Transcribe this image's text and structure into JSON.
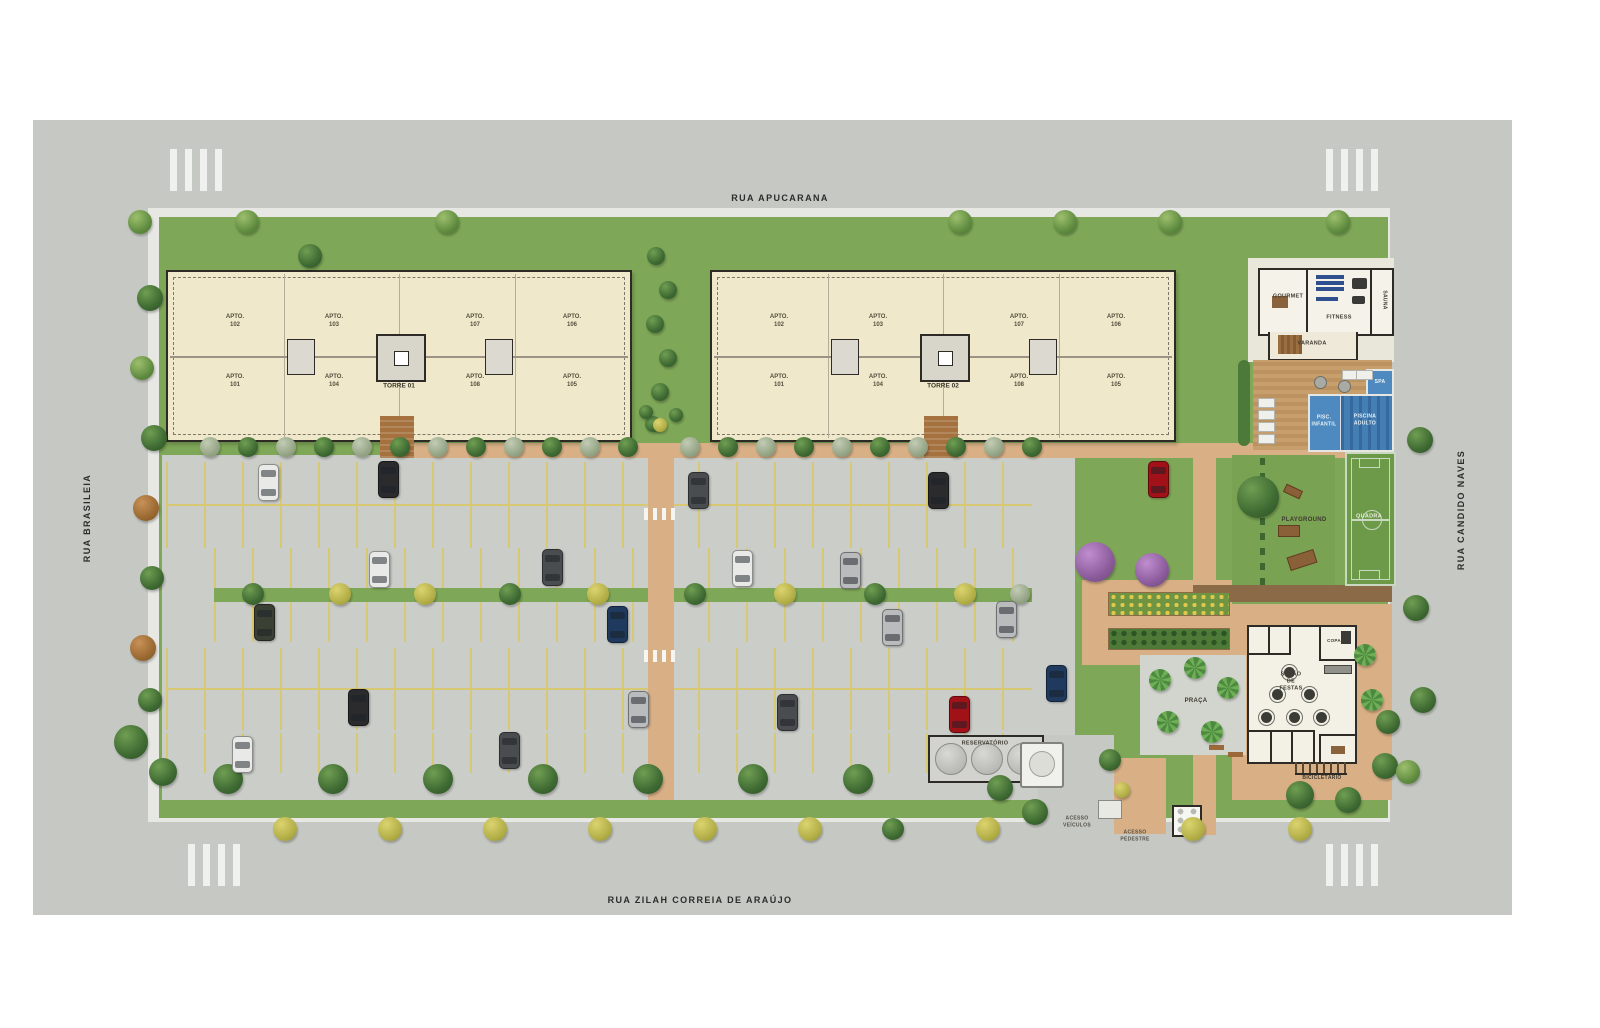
{
  "streets": {
    "top": "RUA APUCARANA",
    "bottom": "RUA ZILAH CORREIA DE ARAÚJO",
    "left": "RUA BRASILEIA",
    "right": "RUA CANDIDO NAVES"
  },
  "colors": {
    "stall": "#d8c873",
    "grass": "#7ea757",
    "asphalt": "#cbcdc9",
    "street": "#c6c8c3",
    "path": "#d9b086",
    "pool": "#3e7cb5",
    "cars": {
      "white": "#e9e9e7",
      "black": "#2b2b2d",
      "charcoal": "#4a4d4f",
      "silver": "#b9bbbd",
      "navy": "#1f3a5e",
      "red": "#a01218",
      "olive": "#3a4034"
    }
  },
  "towers": [
    {
      "label": "TORRE 01",
      "x": 166,
      "y": 270,
      "w": 462,
      "h": 168,
      "apts_top": [
        "APTO.\n102",
        "APTO.\n103",
        "APTO.\n107",
        "APTO.\n106"
      ],
      "apts_bottom": [
        "APTO.\n101",
        "APTO.\n104",
        "APTO.\n108",
        "APTO.\n105"
      ]
    },
    {
      "label": "TORRE 02",
      "x": 710,
      "y": 270,
      "w": 462,
      "h": 168,
      "apts_top": [
        "APTO.\n102",
        "APTO.\n103",
        "APTO.\n107",
        "APTO.\n106"
      ],
      "apts_bottom": [
        "APTO.\n101",
        "APTO.\n104",
        "APTO.\n108",
        "APTO.\n105"
      ]
    }
  ],
  "parking": {
    "bands": [
      [
        166,
        462,
        866,
        42,
        0
      ],
      [
        166,
        504,
        866,
        42,
        1
      ],
      [
        214,
        548,
        818,
        40,
        0
      ],
      [
        214,
        602,
        818,
        40,
        0
      ],
      [
        166,
        648,
        866,
        40,
        0
      ],
      [
        166,
        688,
        866,
        40,
        1
      ],
      [
        166,
        733,
        866,
        40,
        0
      ]
    ]
  },
  "labels": [
    {
      "name": "gourmet-label",
      "t": "GOURMET",
      "x": 1288,
      "y": 297,
      "fs": 5.5
    },
    {
      "name": "fitness-label",
      "t": "FITNESS",
      "x": 1339,
      "y": 318,
      "fs": 5.5
    },
    {
      "name": "sauna-label",
      "t": "SAUNA",
      "x": 1384,
      "y": 300,
      "fs": 5,
      "rot": 90
    },
    {
      "name": "varanda-label",
      "t": "VARANDA",
      "x": 1312,
      "y": 344,
      "fs": 5.5
    },
    {
      "name": "spa-label",
      "t": "SPA",
      "x": 1380,
      "y": 382,
      "fs": 5,
      "c": "#f2f6fa"
    },
    {
      "name": "piscina-infantil-label",
      "t": "PISC.\nINFANTIL",
      "x": 1324,
      "y": 421,
      "fs": 5,
      "c": "#eaf2f8"
    },
    {
      "name": "piscina-adulto-label",
      "t": "PISCINA\nADULTO",
      "x": 1365,
      "y": 420,
      "fs": 5,
      "c": "#eaf2f8"
    },
    {
      "name": "playground-label",
      "t": "PLAYGROUND",
      "x": 1304,
      "y": 521,
      "fs": 6
    },
    {
      "name": "quadra-label",
      "t": "QUADRA",
      "x": 1369,
      "y": 517,
      "fs": 5.5,
      "c": "#e8efe0"
    },
    {
      "name": "praca-label",
      "t": "PRAÇA",
      "x": 1196,
      "y": 702,
      "fs": 6
    },
    {
      "name": "salao-festas-label",
      "t": "SALÃO DE\nFESTAS",
      "x": 1291,
      "y": 682,
      "fs": 5.5
    },
    {
      "name": "copa-label",
      "t": "COPA",
      "x": 1334,
      "y": 641,
      "fs": 4.5
    },
    {
      "name": "bicicletario-label",
      "t": "BICICLETÁRIO",
      "x": 1322,
      "y": 778,
      "fs": 5
    },
    {
      "name": "reservatorio-label",
      "t": "RESERVATÓRIO",
      "x": 985,
      "y": 744,
      "fs": 5.5
    },
    {
      "name": "acesso-veiculos-label",
      "t": "ACESSO\nVEÍCULOS",
      "x": 1077,
      "y": 822,
      "fs": 5,
      "c": "#55524a"
    },
    {
      "name": "acesso-pedestre-label",
      "t": "ACESSO\nPEDESTRE",
      "x": 1135,
      "y": 836,
      "fs": 5,
      "c": "#55524a"
    }
  ],
  "trees": [
    [
      140,
      222,
      24,
      "m"
    ],
    [
      247,
      222,
      24,
      "m"
    ],
    [
      447,
      222,
      24,
      "m"
    ],
    [
      960,
      222,
      24,
      "m"
    ],
    [
      1065,
      222,
      24,
      "m"
    ],
    [
      1170,
      222,
      24,
      "m"
    ],
    [
      1338,
      222,
      24,
      "m"
    ],
    [
      310,
      256,
      24,
      "g"
    ],
    [
      656,
      256,
      18,
      "g"
    ],
    [
      668,
      290,
      18,
      "g"
    ],
    [
      655,
      324,
      18,
      "g"
    ],
    [
      668,
      358,
      18,
      "g"
    ],
    [
      660,
      392,
      18,
      "g"
    ],
    [
      653,
      424,
      16,
      "g"
    ],
    [
      210,
      447,
      20,
      "s"
    ],
    [
      248,
      447,
      20,
      "g"
    ],
    [
      286,
      447,
      20,
      "s"
    ],
    [
      324,
      447,
      20,
      "g"
    ],
    [
      362,
      447,
      20,
      "s"
    ],
    [
      400,
      447,
      20,
      "g"
    ],
    [
      438,
      447,
      20,
      "s"
    ],
    [
      476,
      447,
      20,
      "g"
    ],
    [
      514,
      447,
      20,
      "s"
    ],
    [
      552,
      447,
      20,
      "g"
    ],
    [
      590,
      447,
      20,
      "s"
    ],
    [
      628,
      447,
      20,
      "g"
    ],
    [
      690,
      447,
      20,
      "s"
    ],
    [
      728,
      447,
      20,
      "g"
    ],
    [
      766,
      447,
      20,
      "s"
    ],
    [
      804,
      447,
      20,
      "g"
    ],
    [
      842,
      447,
      20,
      "s"
    ],
    [
      880,
      447,
      20,
      "g"
    ],
    [
      918,
      447,
      20,
      "s"
    ],
    [
      956,
      447,
      20,
      "g"
    ],
    [
      994,
      447,
      20,
      "s"
    ],
    [
      1032,
      447,
      20,
      "g"
    ],
    [
      253,
      594,
      22,
      "g"
    ],
    [
      340,
      594,
      22,
      "y"
    ],
    [
      425,
      594,
      22,
      "y"
    ],
    [
      510,
      594,
      22,
      "g"
    ],
    [
      598,
      594,
      22,
      "y"
    ],
    [
      695,
      594,
      22,
      "g"
    ],
    [
      785,
      594,
      22,
      "y"
    ],
    [
      875,
      594,
      22,
      "g"
    ],
    [
      965,
      594,
      22,
      "y"
    ],
    [
      1020,
      594,
      20,
      "s"
    ],
    [
      228,
      779,
      30,
      "g"
    ],
    [
      333,
      779,
      30,
      "g"
    ],
    [
      438,
      779,
      30,
      "g"
    ],
    [
      543,
      779,
      30,
      "g"
    ],
    [
      648,
      779,
      30,
      "g"
    ],
    [
      753,
      779,
      30,
      "g"
    ],
    [
      858,
      779,
      30,
      "g"
    ],
    [
      1000,
      788,
      26,
      "g"
    ],
    [
      285,
      829,
      24,
      "y"
    ],
    [
      390,
      829,
      24,
      "y"
    ],
    [
      495,
      829,
      24,
      "y"
    ],
    [
      600,
      829,
      24,
      "y"
    ],
    [
      705,
      829,
      24,
      "y"
    ],
    [
      810,
      829,
      24,
      "y"
    ],
    [
      893,
      829,
      22,
      "g"
    ],
    [
      988,
      829,
      24,
      "y"
    ],
    [
      1193,
      829,
      24,
      "y"
    ],
    [
      1300,
      829,
      24,
      "y"
    ],
    [
      150,
      298,
      26,
      "g"
    ],
    [
      142,
      368,
      24,
      "m"
    ],
    [
      154,
      438,
      26,
      "g"
    ],
    [
      146,
      508,
      26,
      "o"
    ],
    [
      152,
      578,
      24,
      "g"
    ],
    [
      143,
      648,
      26,
      "o"
    ],
    [
      150,
      700,
      24,
      "g"
    ],
    [
      131,
      742,
      34,
      "g"
    ],
    [
      163,
      772,
      28,
      "g"
    ],
    [
      1095,
      562,
      40,
      "p"
    ],
    [
      1152,
      570,
      34,
      "p"
    ],
    [
      1258,
      497,
      42,
      "g"
    ],
    [
      1160,
      680,
      22,
      "l"
    ],
    [
      1195,
      668,
      22,
      "l"
    ],
    [
      1228,
      688,
      22,
      "l"
    ],
    [
      1168,
      722,
      22,
      "l"
    ],
    [
      1212,
      732,
      22,
      "l"
    ],
    [
      1365,
      655,
      22,
      "l"
    ],
    [
      1372,
      700,
      22,
      "l"
    ],
    [
      1300,
      795,
      28,
      "g"
    ],
    [
      1348,
      800,
      26,
      "g"
    ],
    [
      1385,
      766,
      26,
      "g"
    ],
    [
      1388,
      722,
      24,
      "g"
    ],
    [
      1420,
      440,
      26,
      "g"
    ],
    [
      1416,
      608,
      26,
      "g"
    ],
    [
      1423,
      700,
      26,
      "g"
    ],
    [
      1408,
      772,
      24,
      "m"
    ],
    [
      646,
      412,
      14,
      "g"
    ],
    [
      660,
      425,
      14,
      "y"
    ],
    [
      676,
      415,
      14,
      "g"
    ],
    [
      1035,
      812,
      26,
      "g"
    ],
    [
      1110,
      760,
      22,
      "g"
    ],
    [
      1122,
      790,
      16,
      "y"
    ]
  ],
  "cars": [
    [
      267,
      481,
      "white"
    ],
    [
      387,
      478,
      "black"
    ],
    [
      697,
      489,
      "charcoal"
    ],
    [
      937,
      489,
      "black"
    ],
    [
      1157,
      478,
      "red"
    ],
    [
      378,
      568,
      "white"
    ],
    [
      551,
      566,
      "charcoal"
    ],
    [
      741,
      567,
      "white"
    ],
    [
      849,
      569,
      "silver"
    ],
    [
      263,
      621,
      "olive"
    ],
    [
      616,
      623,
      "navy"
    ],
    [
      891,
      626,
      "silver"
    ],
    [
      1005,
      618,
      "silver"
    ],
    [
      357,
      706,
      "black"
    ],
    [
      637,
      708,
      "silver"
    ],
    [
      786,
      711,
      "charcoal"
    ],
    [
      958,
      713,
      "red"
    ],
    [
      1055,
      682,
      "navy"
    ],
    [
      241,
      753,
      "white"
    ],
    [
      508,
      749,
      "charcoal"
    ]
  ],
  "deck": {
    "loungers": [
      [
        1258,
        398
      ],
      [
        1258,
        410
      ],
      [
        1258,
        422
      ],
      [
        1258,
        434
      ],
      [
        1342,
        370
      ],
      [
        1356,
        370
      ]
    ],
    "tables": [
      [
        1314,
        376
      ],
      [
        1338,
        380
      ]
    ]
  },
  "salao": {
    "tables": [
      [
        1277,
        694
      ],
      [
        1309,
        694
      ],
      [
        1266,
        717
      ],
      [
        1294,
        717
      ],
      [
        1321,
        717
      ],
      [
        1289,
        672
      ]
    ]
  }
}
